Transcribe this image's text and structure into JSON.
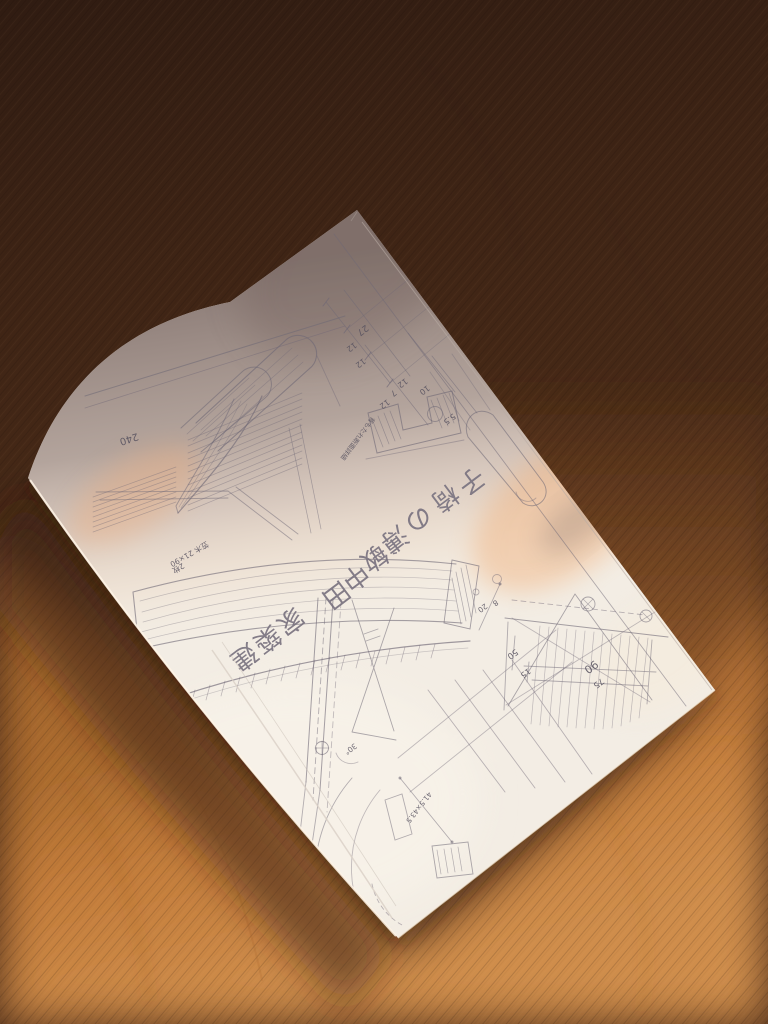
{
  "alt_text": "A stapled booklet of pencil construction drawings for a wooden chair lying rotated on an oak table; upper half of the cover in shadow, lower half in bright warm sunlight.",
  "book": {
    "title": "建築家 田中敏溥の椅子",
    "title_chars": [
      "建",
      "築",
      "家",
      "田",
      "中",
      "敏",
      "溥",
      "の",
      "椅",
      "子"
    ],
    "cover_subject": "hand-drawn chair construction drawings (plans, sections, joinery details)"
  },
  "drawing": {
    "annotations": [
      "240",
      "27",
      "12",
      "12",
      "12",
      "7",
      "12",
      "10",
      "5.5",
      "背もたれ断面詳細",
      "笠木 21×90",
      "2枚",
      "50",
      "15",
      "90",
      "75",
      "20",
      "8",
      "30°",
      "41.5×43.5"
    ]
  },
  "colors": {
    "table_sunlit": "#c9823f",
    "table_shadow": "#3a2315",
    "paper_sunlit": "#f3ede4",
    "paper_shadow": "#ab9c98",
    "paper_glow": "#f0ac74",
    "pencil": "#6e6775"
  }
}
